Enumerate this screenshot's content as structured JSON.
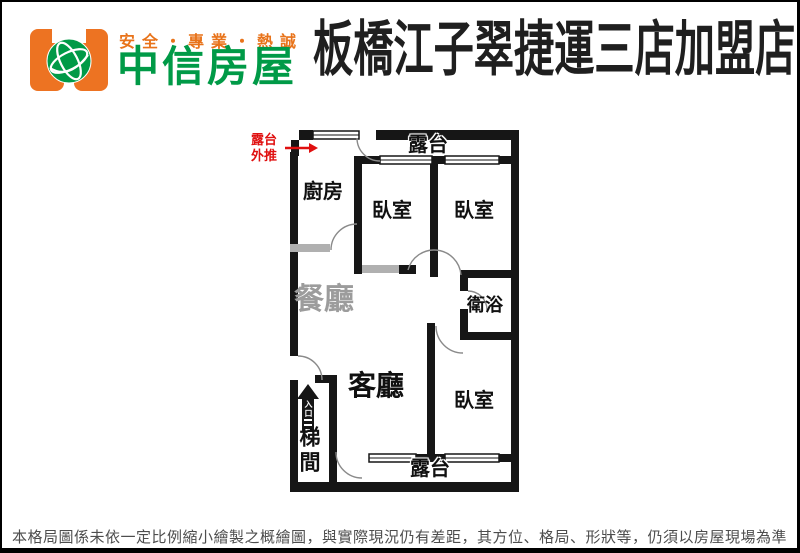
{
  "header": {
    "slogan": "安全・專業・熱誠",
    "brand": "中信房屋",
    "store_title": "板橋江子翠捷運三店加盟店"
  },
  "colors": {
    "brand_orange": "#ed7322",
    "slogan_orange": "#e8731a",
    "brand_green": "#009a47",
    "wall_black": "#161616",
    "light_partition_gray": "#b0b0b0",
    "annotation_red": "#e01010",
    "dining_label_gray": "#9c9c9c",
    "footer_gray": "#4d4d4d"
  },
  "floorplan": {
    "annotation_balcony_pushout": "露台\n外推",
    "rooms": {
      "kitchen": "廚房",
      "bedroom_top_left": "臥室",
      "bedroom_top_right": "臥室",
      "bedroom_bottom_right": "臥室",
      "dining": "餐廳",
      "living": "客廳",
      "bathroom": "衛浴",
      "stairwell": "梯間",
      "balcony_top": "露台",
      "balcony_bottom": "露台",
      "entrance": "入口"
    }
  },
  "footer": {
    "disclaimer": "本格局圖係未依一定比例縮小繪製之概繪圖，與實際現況仍有差距，其方位、格局、形狀等，仍須以房屋現場為準"
  }
}
